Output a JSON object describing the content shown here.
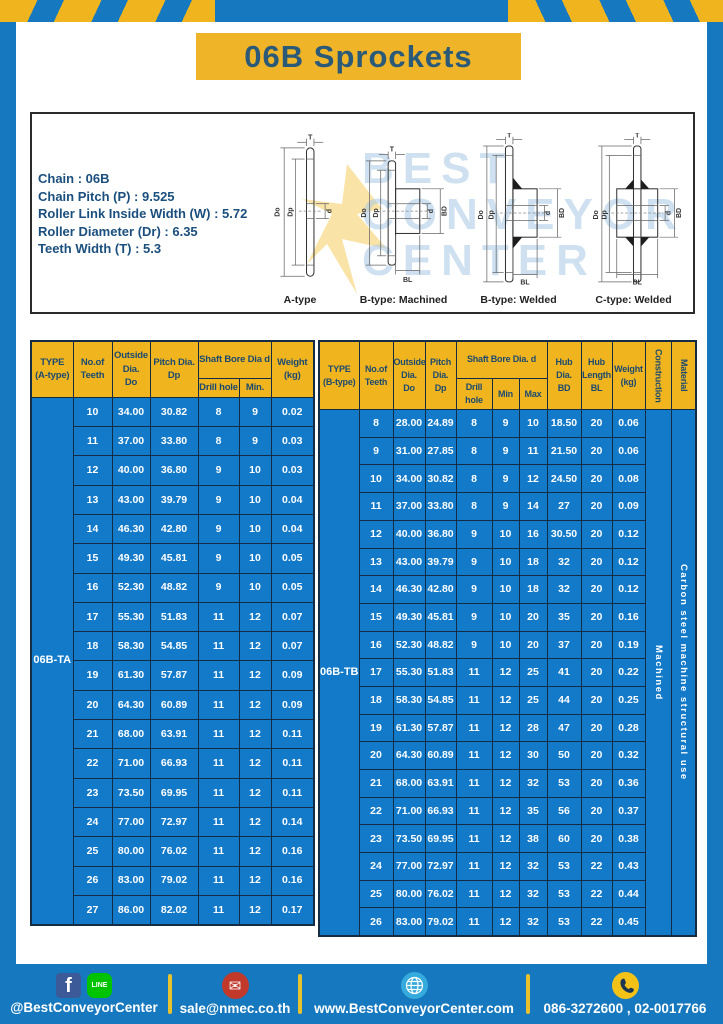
{
  "page": {
    "title": "06B Sprockets"
  },
  "colors": {
    "brand_blue": "#1678be",
    "table_blue": "#127ac9",
    "brand_yellow": "#f0b41f"
  },
  "specs": {
    "lines": [
      "Chain  : 06B",
      "Chain Pitch (P)  :  9.525",
      "Roller Link Inside Width (W)  :  5.72",
      "Roller Diameter (Dr)  : 6.35",
      "Teeth Width (T)  :  5.3"
    ]
  },
  "watermark": {
    "lines": [
      "BEST",
      "CONVEYOR",
      "CENTER"
    ]
  },
  "diagrams": {
    "dims": {
      "t": "T",
      "do_label": "Do",
      "dp": "Dp",
      "d": "d",
      "bd": "BD",
      "bl": "BL"
    },
    "captions": [
      "A-type",
      "B-type: Machined",
      "B-type: Welded",
      "C-type: Welded"
    ]
  },
  "table_a": {
    "type_label": "06B-TA",
    "headers": {
      "type": "TYPE\n(A-type)",
      "teeth": "No.of\nTeeth",
      "outside": "Outside\nDia.\nDo",
      "pitch": "Pitch Dia.\nDp",
      "shaft": "Shaft Bore Dia d",
      "drill": "Drill hole",
      "min": "Min.",
      "weight": "Weight\n(kg)"
    },
    "rows": [
      [
        "10",
        "34.00",
        "30.82",
        "8",
        "9",
        "0.02"
      ],
      [
        "11",
        "37.00",
        "33.80",
        "8",
        "9",
        "0.03"
      ],
      [
        "12",
        "40.00",
        "36.80",
        "9",
        "10",
        "0.03"
      ],
      [
        "13",
        "43.00",
        "39.79",
        "9",
        "10",
        "0.04"
      ],
      [
        "14",
        "46.30",
        "42.80",
        "9",
        "10",
        "0.04"
      ],
      [
        "15",
        "49.30",
        "45.81",
        "9",
        "10",
        "0.05"
      ],
      [
        "16",
        "52.30",
        "48.82",
        "9",
        "10",
        "0.05"
      ],
      [
        "17",
        "55.30",
        "51.83",
        "11",
        "12",
        "0.07"
      ],
      [
        "18",
        "58.30",
        "54.85",
        "11",
        "12",
        "0.07"
      ],
      [
        "19",
        "61.30",
        "57.87",
        "11",
        "12",
        "0.09"
      ],
      [
        "20",
        "64.30",
        "60.89",
        "11",
        "12",
        "0.09"
      ],
      [
        "21",
        "68.00",
        "63.91",
        "11",
        "12",
        "0.11"
      ],
      [
        "22",
        "71.00",
        "66.93",
        "11",
        "12",
        "0.11"
      ],
      [
        "23",
        "73.50",
        "69.95",
        "11",
        "12",
        "0.11"
      ],
      [
        "24",
        "77.00",
        "72.97",
        "11",
        "12",
        "0.14"
      ],
      [
        "25",
        "80.00",
        "76.02",
        "11",
        "12",
        "0.16"
      ],
      [
        "26",
        "83.00",
        "79.02",
        "11",
        "12",
        "0.16"
      ],
      [
        "27",
        "86.00",
        "82.02",
        "11",
        "12",
        "0.17"
      ]
    ]
  },
  "table_b": {
    "type_label": "06B-TB",
    "construction_value": "Machined",
    "material_value": "Carbon  steel  machine  structural  use",
    "headers": {
      "type": "TYPE\n(B-type)",
      "teeth": "No.of\nTeeth",
      "outside": "Outside\nDia.\nDo",
      "pitch": "Pitch\nDia.\nDp",
      "shaft": "Shaft Bore Dia.  d",
      "drill": "Drill hole",
      "min": "Min",
      "max": "Max",
      "hub_dia": "Hub\nDia.\nBD",
      "hub_len": "Hub\nLength\nBL",
      "weight": "Weight\n(kg)",
      "construction": "Construction",
      "material": "Material"
    },
    "rows": [
      [
        "8",
        "28.00",
        "24.89",
        "8",
        "9",
        "10",
        "18.50",
        "20",
        "0.06"
      ],
      [
        "9",
        "31.00",
        "27.85",
        "8",
        "9",
        "11",
        "21.50",
        "20",
        "0.06"
      ],
      [
        "10",
        "34.00",
        "30.82",
        "8",
        "9",
        "12",
        "24.50",
        "20",
        "0.08"
      ],
      [
        "11",
        "37.00",
        "33.80",
        "8",
        "9",
        "14",
        "27",
        "20",
        "0.09"
      ],
      [
        "12",
        "40.00",
        "36.80",
        "9",
        "10",
        "16",
        "30.50",
        "20",
        "0.12"
      ],
      [
        "13",
        "43.00",
        "39.79",
        "9",
        "10",
        "18",
        "32",
        "20",
        "0.12"
      ],
      [
        "14",
        "46.30",
        "42.80",
        "9",
        "10",
        "18",
        "32",
        "20",
        "0.12"
      ],
      [
        "15",
        "49.30",
        "45.81",
        "9",
        "10",
        "20",
        "35",
        "20",
        "0.16"
      ],
      [
        "16",
        "52.30",
        "48.82",
        "9",
        "10",
        "20",
        "37",
        "20",
        "0.19"
      ],
      [
        "17",
        "55.30",
        "51.83",
        "11",
        "12",
        "25",
        "41",
        "20",
        "0.22"
      ],
      [
        "18",
        "58.30",
        "54.85",
        "11",
        "12",
        "25",
        "44",
        "20",
        "0.25"
      ],
      [
        "19",
        "61.30",
        "57.87",
        "11",
        "12",
        "28",
        "47",
        "20",
        "0.28"
      ],
      [
        "20",
        "64.30",
        "60.89",
        "11",
        "12",
        "30",
        "50",
        "20",
        "0.32"
      ],
      [
        "21",
        "68.00",
        "63.91",
        "11",
        "12",
        "32",
        "53",
        "20",
        "0.36"
      ],
      [
        "22",
        "71.00",
        "66.93",
        "11",
        "12",
        "35",
        "56",
        "20",
        "0.37"
      ],
      [
        "23",
        "73.50",
        "69.95",
        "11",
        "12",
        "38",
        "60",
        "20",
        "0.38"
      ],
      [
        "24",
        "77.00",
        "72.97",
        "11",
        "12",
        "32",
        "53",
        "22",
        "0.43"
      ],
      [
        "25",
        "80.00",
        "76.02",
        "11",
        "12",
        "32",
        "53",
        "22",
        "0.44"
      ],
      [
        "26",
        "83.00",
        "79.02",
        "11",
        "12",
        "32",
        "53",
        "22",
        "0.45"
      ]
    ]
  },
  "footer": {
    "facebook_label": "f",
    "line_label": "LINE",
    "social_handle": "@BestConveyorCenter",
    "email": "sale@nmec.co.th",
    "website": "www.BestConveyorCenter.com",
    "phones": "086-3272600 , 02-0017766"
  }
}
